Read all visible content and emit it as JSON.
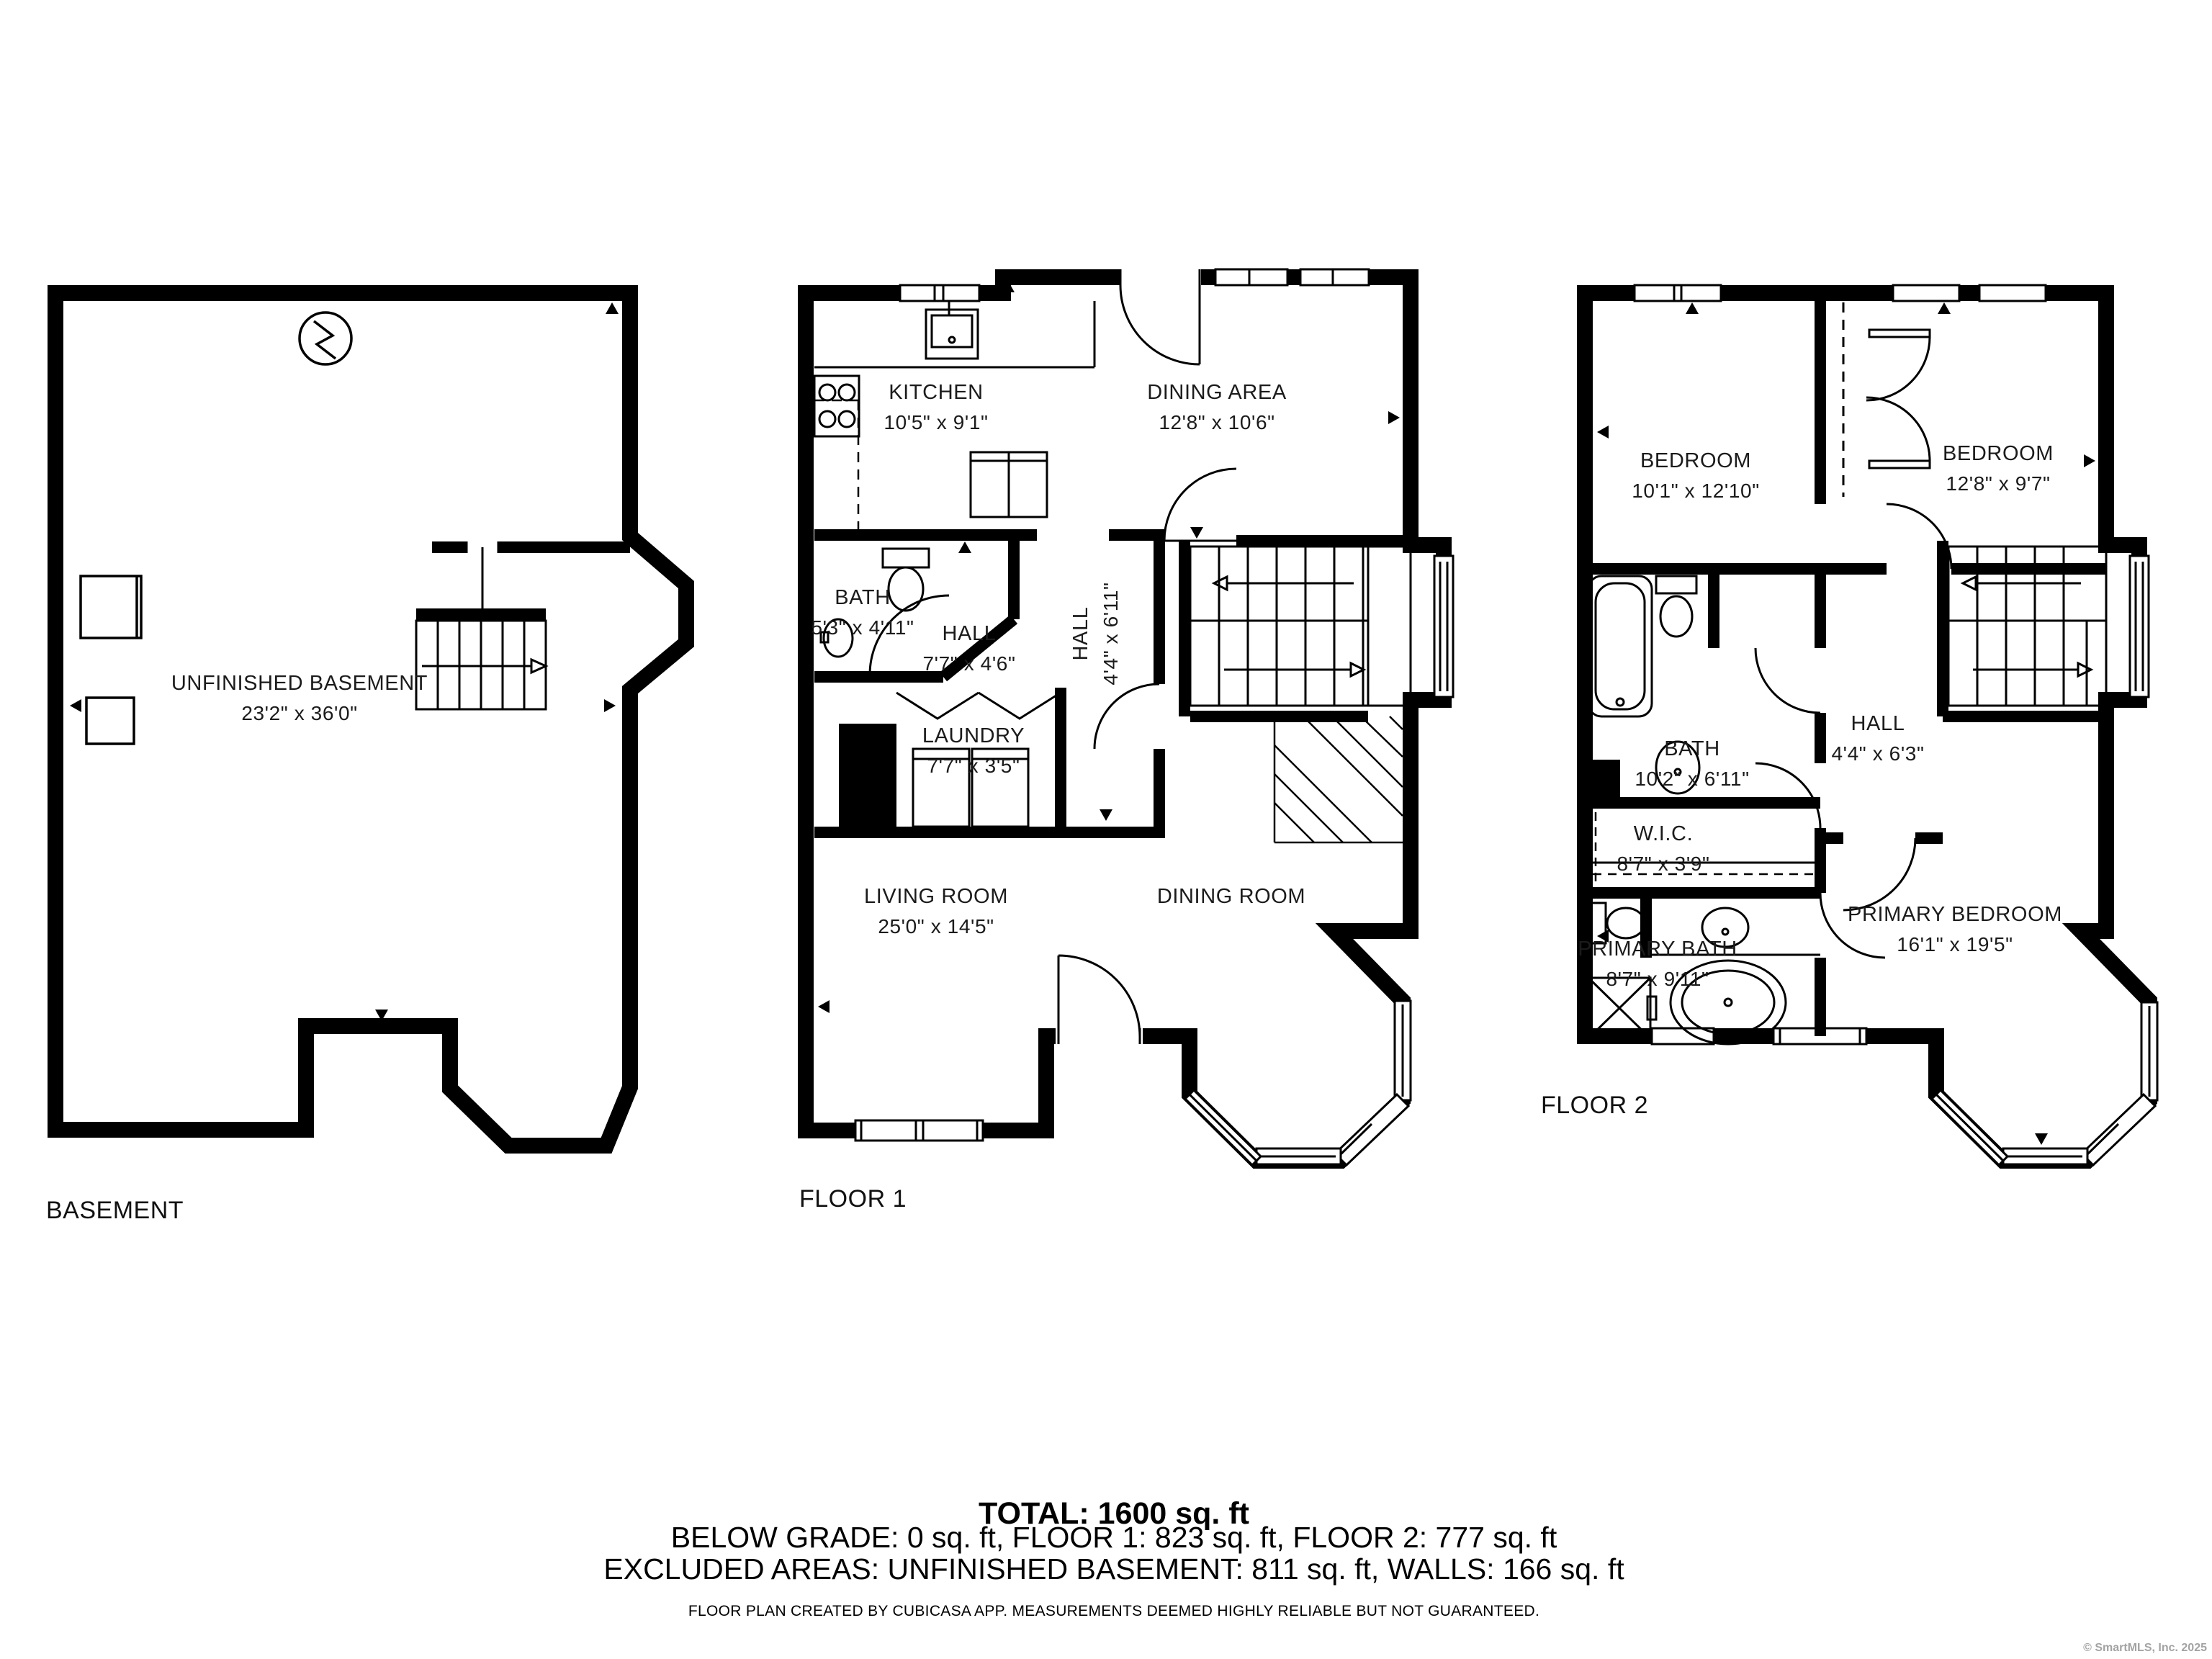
{
  "floors": [
    {
      "label": "BASEMENT",
      "rooms": [
        {
          "name": "UNFINISHED BASEMENT",
          "dims": "23'2\" x 36'0\""
        }
      ]
    },
    {
      "label": "FLOOR 1",
      "rooms": [
        {
          "name": "KITCHEN",
          "dims": "10'5\" x 9'1\""
        },
        {
          "name": "DINING AREA",
          "dims": "12'8\" x 10'6\""
        },
        {
          "name": "BATH",
          "dims": "5'3\" x 4'11\""
        },
        {
          "name": "HALL",
          "dims": "7'7\" x 4'6\""
        },
        {
          "name": "HALL",
          "dims": "4'4\" x 6'11\""
        },
        {
          "name": "LAUNDRY",
          "dims": "7'7\" x 3'5\""
        },
        {
          "name": "LIVING ROOM",
          "dims": "25'0\" x 14'5\""
        },
        {
          "name": "DINING ROOM",
          "dims": ""
        }
      ]
    },
    {
      "label": "FLOOR 2",
      "rooms": [
        {
          "name": "BEDROOM",
          "dims": "10'1\" x 12'10\""
        },
        {
          "name": "BEDROOM",
          "dims": "12'8\" x 9'7\""
        },
        {
          "name": "BATH",
          "dims": "10'2\" x 6'11\""
        },
        {
          "name": "HALL",
          "dims": "4'4\" x 6'3\""
        },
        {
          "name": "W.I.C.",
          "dims": "8'7\" x 3'9\""
        },
        {
          "name": "PRIMARY BATH",
          "dims": "8'7\" x 9'11\""
        },
        {
          "name": "PRIMARY BEDROOM",
          "dims": "16'1\" x 19'5\""
        }
      ]
    }
  ],
  "title_block": {
    "total": "TOTAL: 1600 sq. ft",
    "areas": "BELOW GRADE: 0 sq. ft, FLOOR 1: 823 sq. ft, FLOOR 2: 777 sq. ft",
    "excluded": "EXCLUDED AREAS: UNFINISHED BASEMENT: 811 sq. ft, WALLS: 166 sq. ft",
    "disclaimer": "FLOOR PLAN CREATED BY CUBICASA APP. MEASUREMENTS DEEMED HIGHLY RELIABLE BUT NOT GUARANTEED.",
    "copyright": "© SmartMLS, Inc. 2025"
  }
}
